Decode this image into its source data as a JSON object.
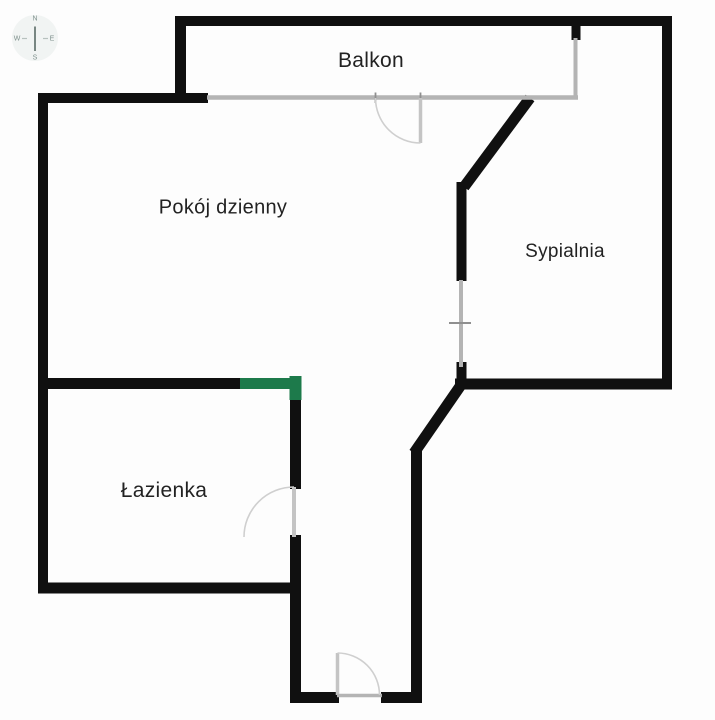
{
  "document": {
    "type": "apartment-floor-plan"
  },
  "compass": {
    "north": "N",
    "south": "S",
    "east": "E",
    "west": "W"
  },
  "rooms": {
    "balkon": {
      "label": "Balkon"
    },
    "pokoj_dzienny": {
      "label": "Pokój dzienny"
    },
    "sypialnia": {
      "label": "Sypialnia"
    },
    "lazienka": {
      "label": "Łazienka"
    }
  },
  "colors": {
    "wall": "#101010",
    "window_line": "#b4b4b4",
    "door_symbol": "#c9c9c9",
    "corner_marker_green": "#1d7a4b",
    "background": "#fdfdfd",
    "label_text": "#222222"
  }
}
